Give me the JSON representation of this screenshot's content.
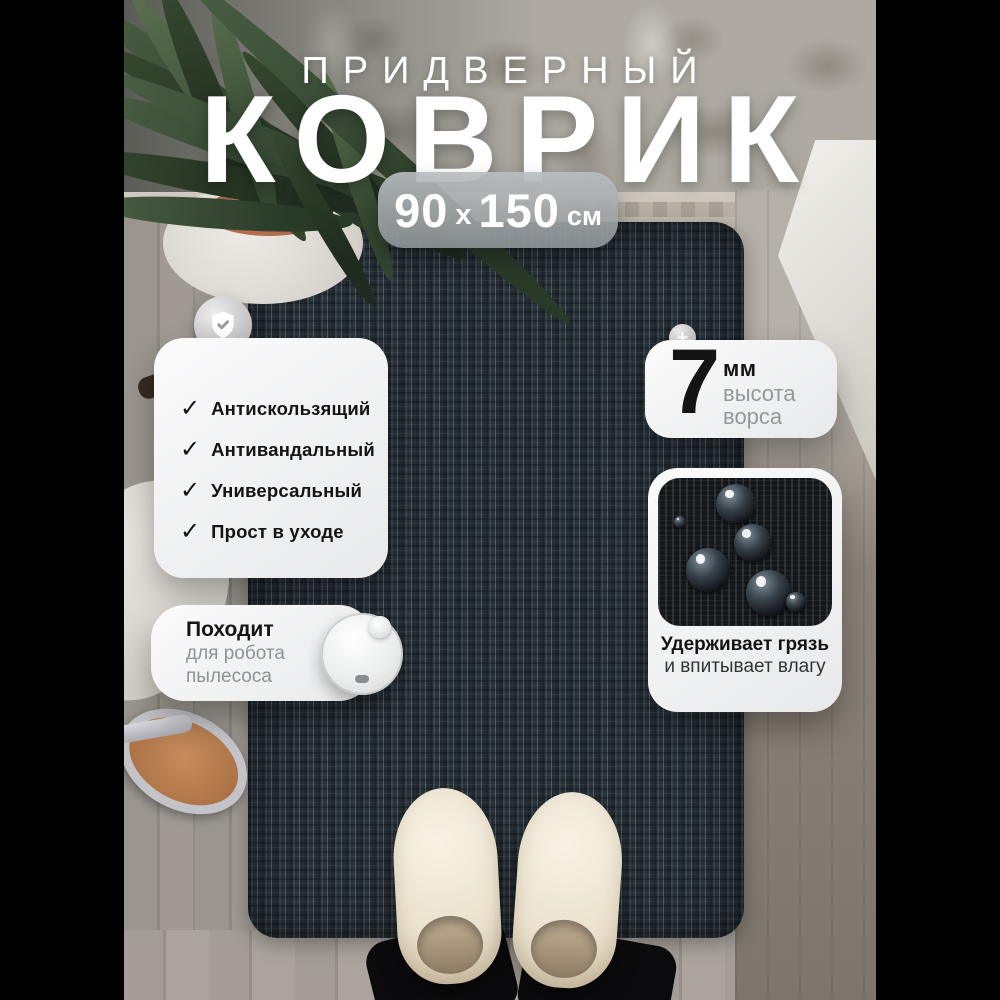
{
  "title": {
    "kicker": "ПРИДВЕРНЫЙ",
    "main": "КОВРИК"
  },
  "size_badge": {
    "width": "90",
    "separator": "x",
    "length": "150",
    "unit": "см"
  },
  "features_card": {
    "items": [
      "Антискользящий",
      "Антивандальный",
      "Универсальный",
      "Прост в уходе"
    ]
  },
  "robot_card": {
    "title": "Походит",
    "line1": "для робота",
    "line2": "пылесоса"
  },
  "pile_card": {
    "value": "7",
    "unit": "мм",
    "label_line1": "высота",
    "label_line2": "ворса"
  },
  "moisture_card": {
    "caption_bold": "Удерживает грязь",
    "caption_regular": "и впитывает влагу"
  },
  "icons": {
    "check": "✓",
    "plus": "+"
  },
  "colors": {
    "pillarbox": "#000000",
    "mat": "#2a343c",
    "card_background": "#f3f3f4",
    "text_dark": "#141414",
    "text_gray": "#8e9296",
    "size_pill": "#9aa0a4",
    "title_text": "#ffffff"
  }
}
